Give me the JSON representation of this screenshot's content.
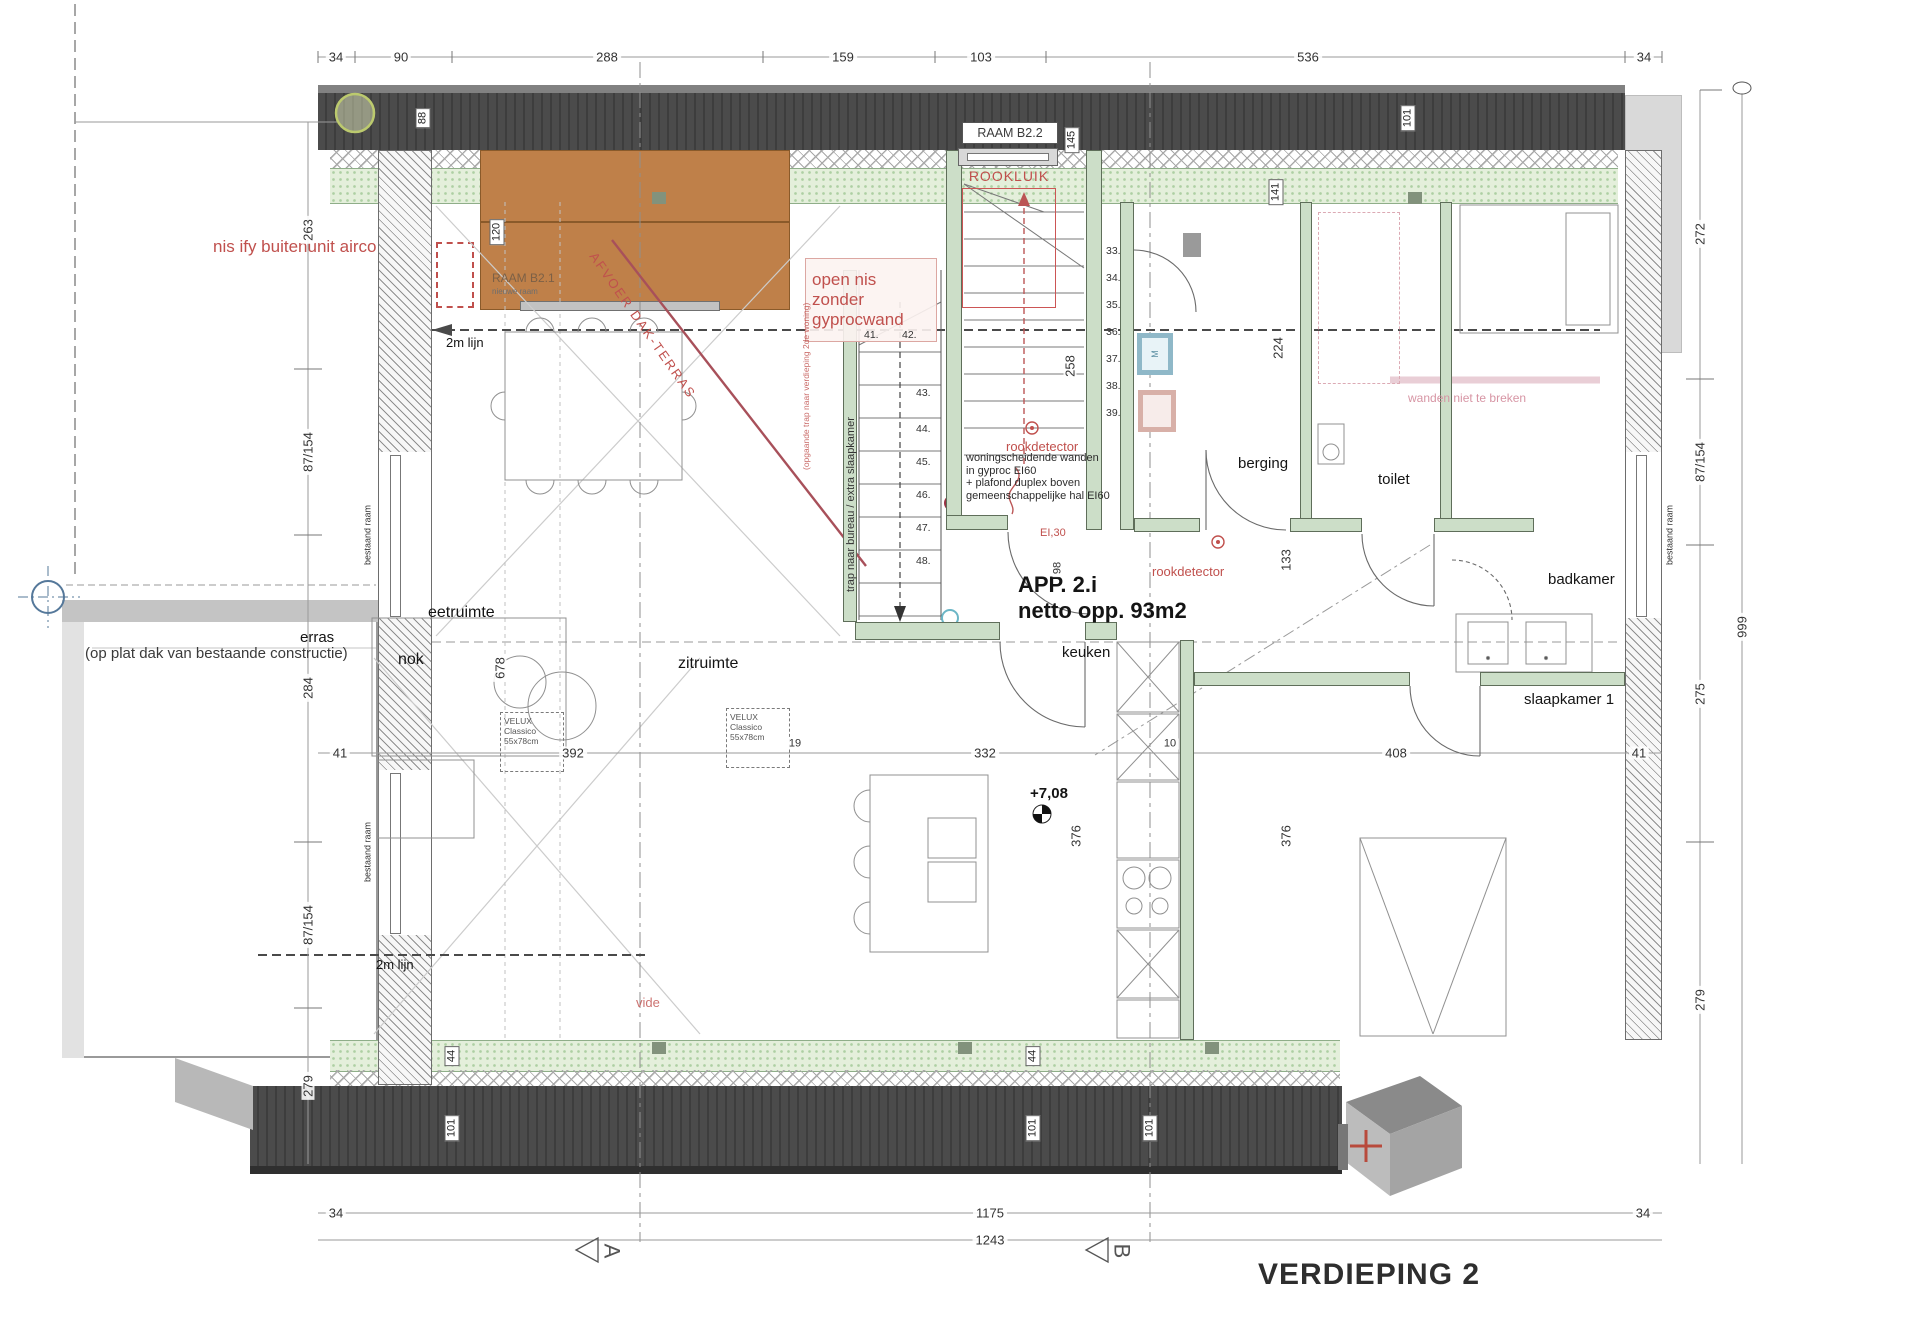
{
  "sheet": {
    "title": "VERDIEPING 2"
  },
  "apartment": {
    "name": "APP. 2.i",
    "area": "netto opp. 93m2",
    "level": "+7,08"
  },
  "rooms": {
    "eetruimte": "eetruimte",
    "zitruimte": "zitruimte",
    "nok": "nok",
    "keuken": "keuken",
    "berging": "berging",
    "toilet": "toilet",
    "badkamer": "badkamer",
    "slaapkamer": "slaapkamer 1",
    "vide": "vide",
    "terras": "erras",
    "terras_note": "(op plat dak van bestaande constructie)",
    "tweem_lijn": "2m lijn"
  },
  "windows": {
    "raam_b21": "RAAM B2.1",
    "raam_b21_sub": "nieuwe raam",
    "raam_b22": "RAAM B2.2",
    "rookluik": "ROOKLUIK",
    "bestaand_raam": "bestaand raam",
    "velux_name": "VELUX Classico",
    "velux_size": "55x78cm"
  },
  "annotations": {
    "airco": "nis ify buitenunit airco",
    "open_nis_1": "open nis zonder",
    "open_nis_2": "gyprocwand",
    "afvoer": "AFVOER DAK-TERRAS",
    "rookdetector": "rookdetector",
    "ei30": "EI,30",
    "ei60_1": "woningscheidende wanden",
    "ei60_2": "in gyproc EI60",
    "ei60_3": "+ plafond duplex boven",
    "ei60_4": "gemeenschappelijke hal EI60",
    "trap_bureau": "trap naar bureau / extra slaapkamer",
    "trap_op": "(opgaande trap naar verdieping 2de woning)",
    "wand_breken": "wanden niet te breken"
  },
  "dims": {
    "top": [
      "34",
      "90",
      "288",
      "159",
      "103",
      "536",
      "34"
    ],
    "mid": [
      "41",
      "392",
      "19",
      "332",
      "10",
      "408",
      "41"
    ],
    "bottom": [
      "34",
      "1175",
      "34"
    ],
    "bottom_total": "1243",
    "left": [
      "263",
      "87/154",
      "284",
      "87/154",
      "279"
    ],
    "right": [
      "272",
      "87/154",
      "275",
      "279"
    ],
    "right_total": "999",
    "wall_top": [
      "88",
      "120",
      "145",
      "141",
      "101"
    ],
    "wall_bottom": [
      "44",
      "101",
      "44",
      "101",
      "101"
    ],
    "interior": [
      "224",
      "258",
      "133",
      "98",
      "678",
      "376",
      "376"
    ]
  },
  "stairs": {
    "right": [
      "33.",
      "34.",
      "35.",
      "36.",
      "37.",
      "38.",
      "39."
    ],
    "left_top": [
      "41.",
      "42."
    ],
    "left": [
      "43.",
      "44.",
      "45.",
      "46.",
      "47.",
      "48."
    ]
  },
  "markers": {
    "a": "A",
    "b": "B",
    "m": "M"
  },
  "colors": {
    "roof": "#4b4b4b",
    "insulation": "#e4efdb",
    "accent_red": "#c0504d",
    "window_orange": "#bf8049",
    "annotation_pink": "#d795a4",
    "wall_green": "#ccdec8"
  }
}
